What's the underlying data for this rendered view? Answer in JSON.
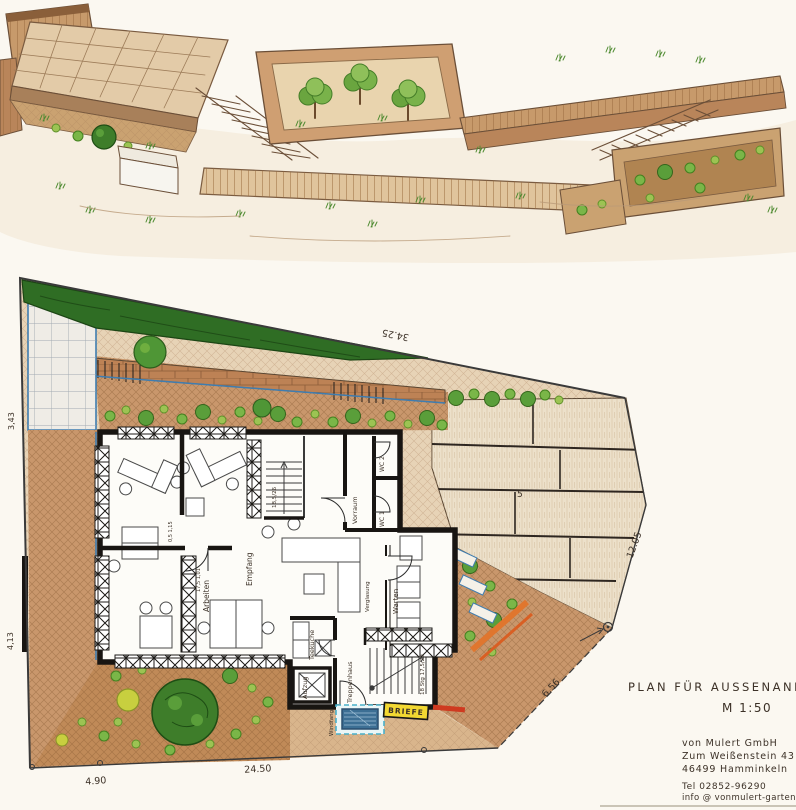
{
  "doc": {
    "title": "PLAN FÜR AUSSENANLAGE",
    "scale": "M 1:50",
    "company": "von Mulert GmbH",
    "street": "Zum Weißenstein 43",
    "city": "46499 Hamminkeln",
    "phone": "Tel 02852-96290",
    "email": "info @ vonmulert-gartenbau.de"
  },
  "rooms": {
    "empfang": "Empfang",
    "arbeiten": "Arbeiten",
    "vorraum": "Vorraum",
    "wc1": "WC 1",
    "wc2": "WC 2",
    "warten": "Warten",
    "verglasung": "Verglasung",
    "teekueche": "Teeküche",
    "aufzug": "Aufzug",
    "treppenhaus": "Treppenhaus",
    "windfang": "Windfang",
    "briefe": "BRIEFE"
  },
  "stairs": {
    "main_note": "18 Stg 17,5/29",
    "upper_note": "18,5/26"
  },
  "dimensions": {
    "top": "34.25",
    "bottom": "24.50",
    "right": "12.05",
    "diagonal": "6.56",
    "bottom_left": "4.90",
    "left_upper": "3,43",
    "left_lower": "4,13",
    "door_a": "0,5 1,15",
    "door_b": "17,5 1,01",
    "slab_mark": "5"
  },
  "colors": {
    "paper": "#fbf8f1",
    "ink": "#3c3127",
    "paving": "#c9976c",
    "slab": "#ece0ca",
    "green": "#6aa53f",
    "hedge": "#2f6d24",
    "blue": "#3f7db0",
    "yellow": "#f2d832",
    "orange": "#e0762e",
    "red": "#cf3a20"
  }
}
